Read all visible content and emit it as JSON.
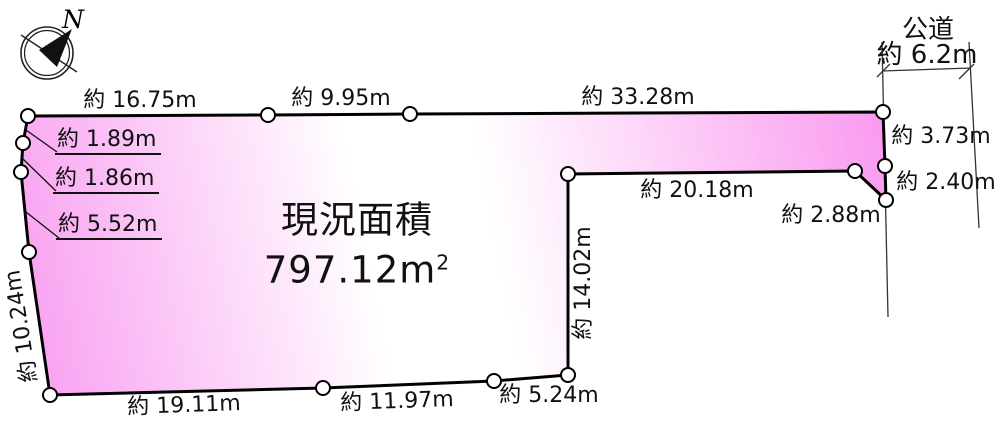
{
  "compass": {
    "north": "N"
  },
  "road": {
    "name": "公道",
    "width": "約 6.2m"
  },
  "area": {
    "label": "現況面積",
    "value": "797.12m",
    "unit_exp": "2"
  },
  "dimensions": {
    "top_1": "約 16.75m",
    "top_2": "約 9.95m",
    "top_3": "約 33.28m",
    "right_1": "約 3.73m",
    "right_2": "約 2.40m",
    "right_3": "約 2.88m",
    "notch_top": "約 20.18m",
    "notch_side": "約 14.02m",
    "bottom_1": "約 19.11m",
    "bottom_2": "約 11.97m",
    "bottom_3": "約 5.24m",
    "left_side": "約 10.24m",
    "left_top_1": "約 1.89m",
    "left_top_2": "約 1.86m",
    "left_top_3": "約 5.52m"
  },
  "colors": {
    "plot_pink": "#f99bef",
    "plot_white": "#ffffff",
    "outline": "#000000"
  }
}
